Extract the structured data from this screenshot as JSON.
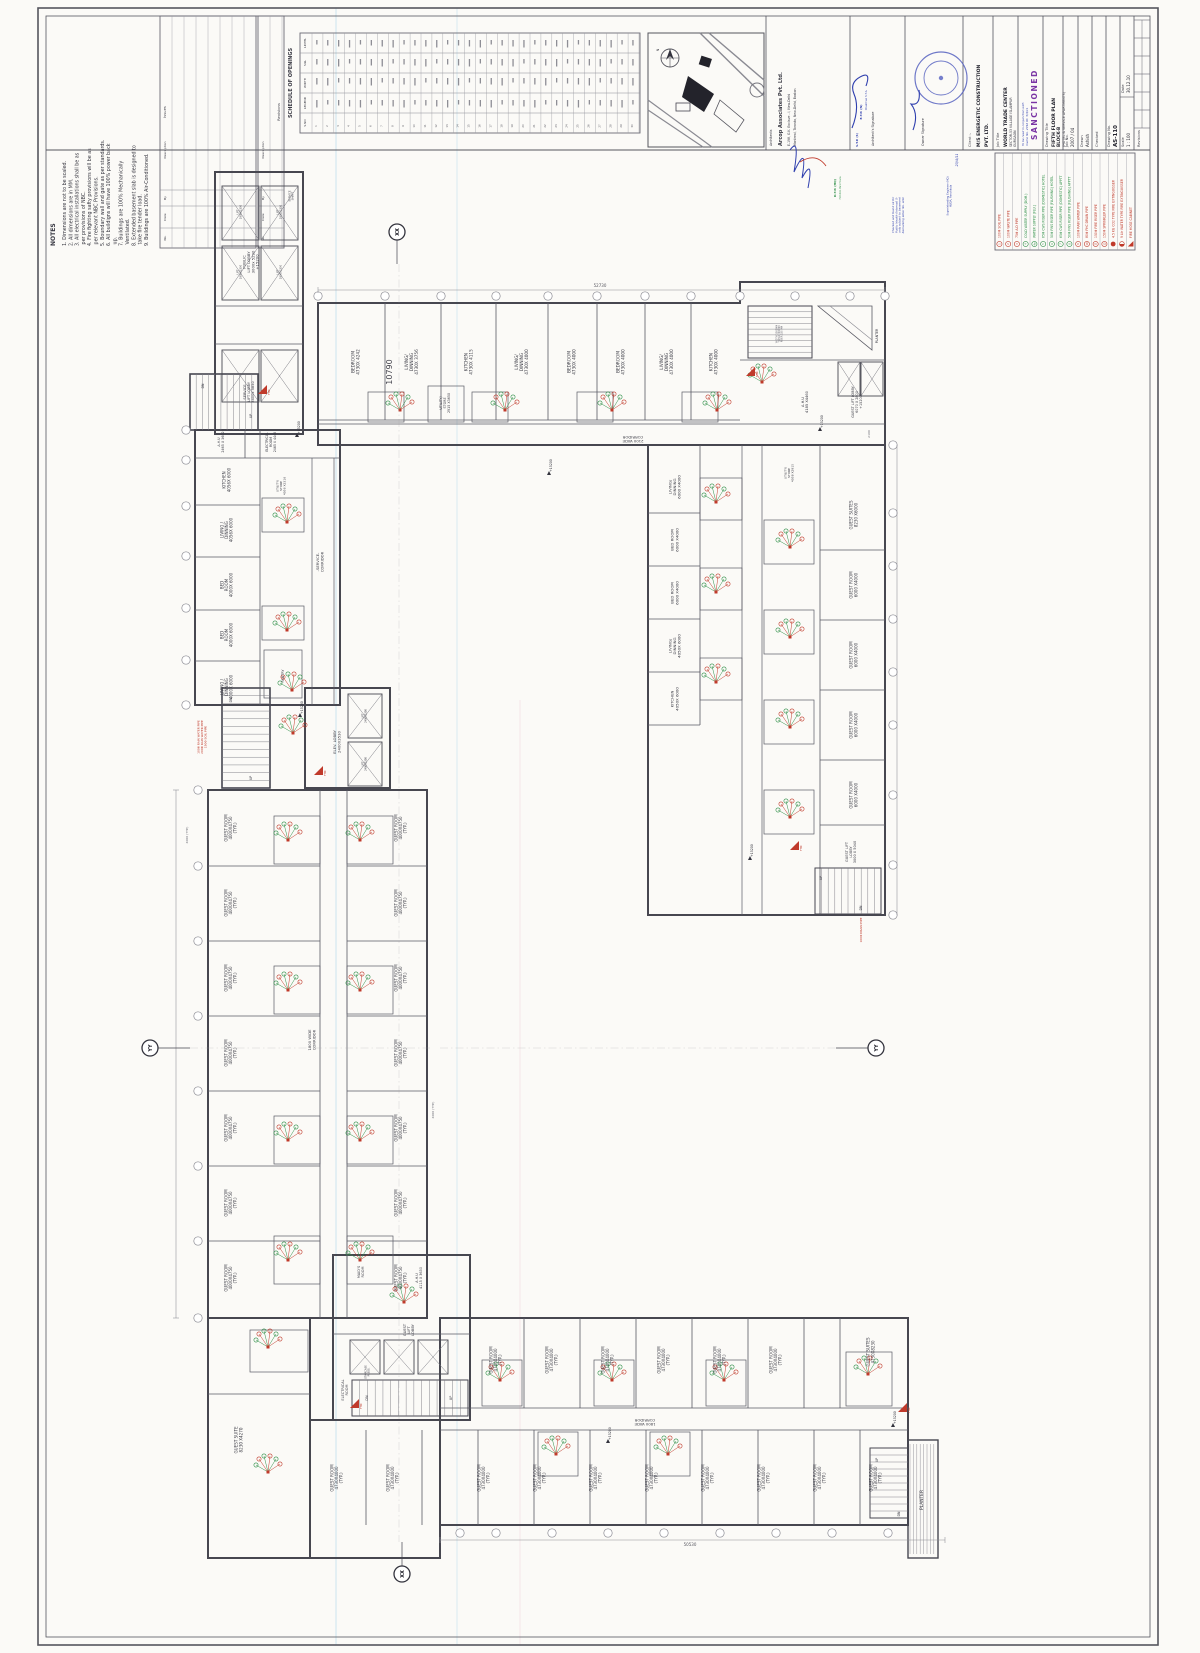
{
  "colors": {
    "wall": "#474750",
    "inner": "#5a5a64",
    "dim": "#8d8d96",
    "red": "#c03a2b",
    "green": "#2e8f47",
    "blue_ink": "#2f3fae",
    "purple": "#7a35a4",
    "cyan_fold": "#b9dcec",
    "pink_fold": "#eed3da",
    "seal": "#5560c0"
  },
  "notes": {
    "title": "NOTES",
    "items": [
      "1. Dimensions are not to be scaled.",
      "2. All dimensions are in MM.",
      "3. All electrical installations shall be as per provisions of NBC.",
      "4. Fire fighting safty provisions will be as per relevant NBC Provisions.",
      "5. Boundary wall and gate as per standards.",
      "6. All buildigns will have 100% power back up.",
      "7. Buildings are 100% Mechanically Ventilated.",
      "8. Extended basement slab is designed to take fire tender load.",
      "9. Buildings are 100% Air-Conditioned."
    ]
  },
  "issues_table": {
    "title": "Issues",
    "columns": [
      "No.",
      "Date",
      "By",
      "Description"
    ]
  },
  "revisions_table": {
    "title": "Revisions",
    "columns": [
      "No.",
      "Date",
      "By",
      "Description"
    ]
  },
  "schedule": {
    "title": "SCHEDULE OF OPENINGS",
    "columns": [
      "S.NO",
      "LEGEND",
      "WIDTH",
      "SILL",
      "LINTEL"
    ],
    "row_count": 30
  },
  "key_plan": {
    "north_label": "N"
  },
  "architects": {
    "label": "Architects",
    "name": "Arcop Associates Pvt. Ltd.",
    "addr1": "E-198, G.K. Enclave - I, New-Delhi",
    "addr2": "Montreal, Toronto, New-Delhi, Boston",
    "sig": "Architect's Signature",
    "owner_sig": "Owner Signature"
  },
  "stamps": {
    "sanctioned": "SANCTIONED",
    "sanction_note1": "To be read in conjunction with",
    "sanction_note2": "memo No. 2742  Dt. 5/4/11",
    "checked_note": "Checked and found ok for\nPublic Health (Internal) S-\nonly subject to basement\nRemarking letter No. attd.",
    "se1": "Superintending Engineer (HQ)",
    "se2": "HUDA, Panchkula",
    "date_mark": "23/4/11",
    "etp": "E.T.P. (N)",
    "chairman": "Chairman S.T.A.",
    "stp": "S.T.P. (S)",
    "atp1": "D.T.P. (HQ)",
    "atp2": "H.U.D.A. Panchkula"
  },
  "titleblock": {
    "client_label": "Client :-",
    "client_line1": "M/S ENERGETIC CONSTRUCTION",
    "client_line2": "PVT. LTD.",
    "job_title_label": "Job Title",
    "job_title": "WORLD TRADE CENTER",
    "job_loc1": "SECTOR-53 VILLAGE ISLAMPUR",
    "job_loc2": "GURGAON",
    "drawing_title_label": "Drawing Title",
    "dt1": "FIFTH FLOOR PLAN",
    "dt2": "BLOCK-B",
    "dt3": "(HOTEL & SERVICE APARTMENTS)",
    "job_no_label": "Job No.",
    "job_no": "2007 / 04",
    "drawn_label": "Drawn",
    "drawn": "Ashish",
    "checked_label": "Checked",
    "drawing_no_label": "Drawing No.",
    "drawing_no": "AS-110",
    "scale_label": "Scale",
    "scale": "1 : 100",
    "date_label": "Date",
    "date": "30.12.10",
    "revisions_label": "Revisions"
  },
  "legend": {
    "items": [
      {
        "no": "1",
        "text": "100Φ SOIL PIPE",
        "color": "red",
        "icon": "circle-number"
      },
      {
        "no": "2",
        "text": "100Φ WASTE PIPE",
        "color": "red",
        "icon": "circle-number"
      },
      {
        "no": "3",
        "text": "75Φ A.D PIPE",
        "color": "red",
        "icon": "circle-number"
      },
      {
        "no": "4",
        "text": "COLD WATER SUPPLY (DOM.)",
        "color": "green",
        "icon": "circle-number"
      },
      {
        "no": "4a",
        "text": "WATER SUPPLY (FLU.)",
        "color": "green",
        "icon": "circle-number"
      },
      {
        "no": "5",
        "text": "65Φ CWS RISER PIPE (DOMESTIC) HOTEL",
        "color": "green",
        "icon": "circle-number"
      },
      {
        "no": "6",
        "text": "50Φ FWS RISER PIPE (FLUSHING) HOTEL",
        "color": "green",
        "icon": "circle-number"
      },
      {
        "no": "7",
        "text": "65Φ CWS RISER PIPE (DOMESTIC) APPTT",
        "color": "green",
        "icon": "circle-number"
      },
      {
        "no": "8",
        "text": "50Φ FWS RISER PIPE (FLUSHING) APPTT",
        "color": "green",
        "icon": "circle-number"
      },
      {
        "no": "9",
        "text": "100Φ RAIN WATER PIPE",
        "color": "red",
        "icon": "circle-number"
      },
      {
        "no": "10",
        "text": "80Φ FHC DRAIN PIPE",
        "color": "red",
        "icon": "circle-number"
      },
      {
        "no": "11",
        "text": "150Φ FIRE RISER PIPE",
        "color": "red",
        "icon": "circle-number"
      },
      {
        "no": "12",
        "text": "150Φ SPRINKLER PIPE",
        "color": "red",
        "icon": "circle-number"
      },
      {
        "no": "13",
        "text": "4.5 KG CO2 TYPE FIRE EXTINGUISSER",
        "color": "red",
        "icon": "filled-circle"
      },
      {
        "no": "14",
        "text": "9 Ltr WATER TYPE FIRE EXTINGUISSER",
        "color": "red",
        "icon": "half-circle"
      },
      {
        "no": "15",
        "text": "FIRE HOSE CABINET",
        "color": "red",
        "icon": "triangle"
      }
    ]
  },
  "plan": {
    "corridor_2100": "2100 WIDE\nCORRIDOR",
    "corridor_1800": "1800 WIDE\nCORRIDOR",
    "service_corridor": "-SERVICE-\nCORRIDOR",
    "public_lift_lobby": "PUBLIC\nLIFT LOBBY\n3000x 5290\n+15200",
    "service_lift_lobby": "SERVICE\nLIFT LOBBY\n2400x 5850",
    "service_shaft": "SERVICE\nSHAFT",
    "lift_1900": "LIFT\n1900X2300",
    "lift_2400": "LIFT\n2400X2300",
    "elev_lobby": "ELEV. LOBBY\n2400X3530",
    "top_rooms": [
      "BEDROOM\n4730X 4242",
      "LIVING/\nDINNING\n4730X 3756",
      "KITCHEN\n4730X 4115",
      "LIVING/\nDINNING\n4730X 4000",
      "BEDROOM\n4730X 4000",
      "BEDROOM\n4730X 4000",
      "LIVING/\nDINNING\n4730X 4000",
      "KITCHEN\n4730X 4000"
    ],
    "utility_store_2915": "UTILITY/\nSTORE\n2915 X3650",
    "left_rooms": [
      "KITCHEN\n4056X 6000",
      "LIVING /\nDINNING\n4056X 6000",
      "BED\nROOM\n4000X 6000",
      "BED\nROOM\n4000X 6000",
      "LIVING /\nDINNING\n4000X 6000"
    ],
    "ahu_2465": "A.H.U\n2465 X 3602",
    "elec_2465": "ELECTRICAL\nROOM\n2465 X 4448",
    "utility_4056": "UTILITY/\nSTORE\n4056 X3316",
    "pantry": "PANTRY",
    "guest_room_4000": "GUEST ROOM\n4000X4750\n(TYP.)",
    "guest_suite_8230_4270": "GUEST SUITE\n8230 X4270",
    "maids_room": "MAID'S\nROOM",
    "ahu_4115_3630": "A.H.U\n4115 X 3630",
    "guest_lift_lobby": "GUEST\nLIFT\nLOBBY",
    "electrical_room": "ELECTRICAL\nROOM",
    "staircase_press": "STAIRCASE\nPRESS.",
    "stair_spec": "WIDTH 1500MM\nTREAD 300MM\nRISER 150 MM",
    "guest_room_4730": "GUEST ROOM\n4730X4000\n(TYP.)",
    "guest_suites_4730": "GUEST SUITES\n4730X8230",
    "planter": "PLANTER",
    "right_rooms_left": [
      "LIVING/\nDINNING\n6000 X4000",
      "BED ROOM\n6000 X4000",
      "BED ROOM\n6000 X4000",
      "LIVING/\nDINNING\n4050X 6000",
      "KITCHEN\n4050X 6000"
    ],
    "utility_4058": "UTILITY/\nSTORE\n4058 X2915",
    "guest_suites_8230": "GUEST SUITES\n8230 X6000",
    "guest_room_6000": "GUEST ROOM\n6000 X4000",
    "guest_lift_lobby_3000": "GUEST LIFT\nLOBBY\n3000 X 5040",
    "guest_lift_lobby_6070": "GUEST LIFT LOBBY\n6070 X 2800\n+15200",
    "ahu_4185": "A.H.U\n4185 X4460",
    "level": "+15200",
    "up": "UP",
    "dn": "DN",
    "fhc": "FHC",
    "marker_xx": "XX",
    "marker_yy": "YY",
    "dim_10790": "10790",
    "dim_52730": "52730",
    "dim_50530": "50530",
    "dim_2100": "2100",
    "dim_4000_typ": "4000 (TYP.)",
    "red_pipes_note": "100Φ RAIN WATER PIPE\n200Φ RAIN WATER PIPE\n150Φ SOIL PIPE",
    "drain_note": "100Φ DRAIN PIPE"
  }
}
